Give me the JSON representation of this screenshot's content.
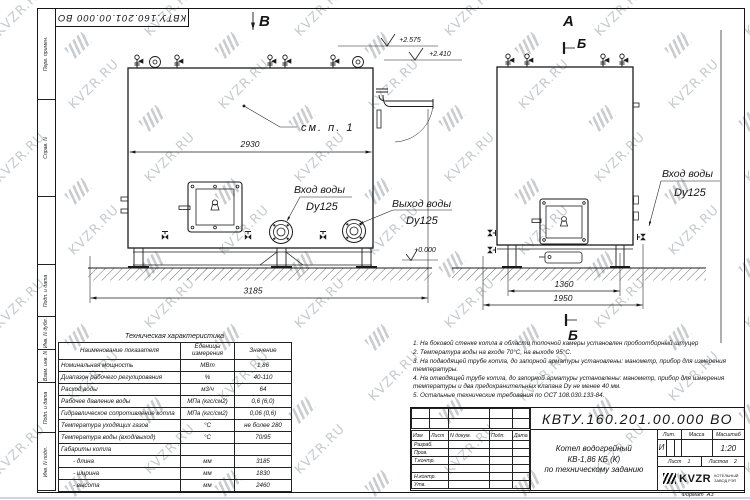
{
  "sheet": {
    "doc_number_reversed": "КВТУ.160.201.00.000 ВО"
  },
  "frame": {
    "side_labels": [
      "Перв. примен.",
      "Справ. N",
      "Подп. и дата",
      "Инв. N дубл.",
      "Взам. инв. N",
      "Подп. и дата",
      "Инв. N подл."
    ]
  },
  "watermark": {
    "text": "KVZR.RU"
  },
  "drawing": {
    "view_b_label": "В",
    "view_a_label": "А",
    "section_label_top": "Б",
    "section_label_bottom": "Б",
    "see_note_label": "см. п. 1",
    "level_2575": "+2.575",
    "level_2410": "+2.410",
    "level_0000": "+0.000",
    "dim_2930": "2930",
    "dim_3185": "3185",
    "dim_1360": "1360",
    "dim_1950": "1950",
    "water_inlet_label": "Вход воды",
    "water_inlet_dy": "Dy125",
    "water_outlet_label": "Выход воды",
    "water_outlet_dy": "Dy125",
    "water_inlet2_label": "Вход воды",
    "water_inlet2_dy": "Dy125"
  },
  "tech_table": {
    "title": "Техническая характеристика",
    "headers": [
      "Наименование показателя",
      "Еденицы измерения",
      "Значение"
    ],
    "rows": [
      [
        "Номинальная мощность",
        "МВт",
        "1,86"
      ],
      [
        "Диапазон рабочего регулирования",
        "%",
        "40-110"
      ],
      [
        "Расход воды",
        "м3/ч",
        "64"
      ],
      [
        "Рабочее давление воды",
        "МПа (кгс/см2)",
        "0,6 (6,0)"
      ],
      [
        "Гидравлическое сопротивление котла",
        "МПа (кгс/см2)",
        "0,06 (0,6)"
      ],
      [
        "Температура уходящих газов",
        "°С",
        "не более 280"
      ],
      [
        "Температура воды (вход/выход)",
        "°С",
        "70/95"
      ],
      [
        "Габариты котла",
        "",
        ""
      ],
      [
        "- длина",
        "мм",
        "3185"
      ],
      [
        "- ширина",
        "мм",
        "1830"
      ],
      [
        "- высота",
        "мм",
        "2460"
      ]
    ]
  },
  "notes": [
    "1. На боковой стенке котла в области топочной камеры установлен пробоотборный штуцер",
    "2. Температура воды на входе 70°С, на выходе 95°С.",
    "3. На подводящей трубе котла, до запорной арматуры установлены: манометр, прибор для измерения температуры.",
    "4. На отводящей трубе котла, до запорной арматуры установлены: манометр, прибор для измерения температуры и два предохранительных клапана Dу не менее 40 мм.",
    "5. Остальные технические требования по ОСТ 108.030.133-84."
  ],
  "title_block": {
    "doc_number": "КВТУ.160.201.00.000 ВО",
    "columns": [
      "Изм",
      "Лист",
      "N докум.",
      "Подп.",
      "Дата"
    ],
    "rows": [
      "Разраб.",
      "Пров.",
      "Т.контр.",
      "",
      "Н.контр.",
      "Утв."
    ],
    "product_title": [
      "Котел водогрейный",
      "КВ-1,86 КБ (К)",
      "по техническому заданию"
    ],
    "lit_header": "Лит.",
    "mass_header": "Масса",
    "scale_header": "Масштаб",
    "lit_value": "И",
    "mass_value": "",
    "scale_value": "1:20",
    "sheet_label": "Лист",
    "sheet_number": "1",
    "sheets_label": "Листов",
    "sheets_total": "2",
    "logo_text": "KVZR",
    "logo_sub1": "КОТЕЛЬНЫЙ",
    "logo_sub2": "ЗАВОД РЭП",
    "format_label": "Формат",
    "format_value": "А3"
  }
}
